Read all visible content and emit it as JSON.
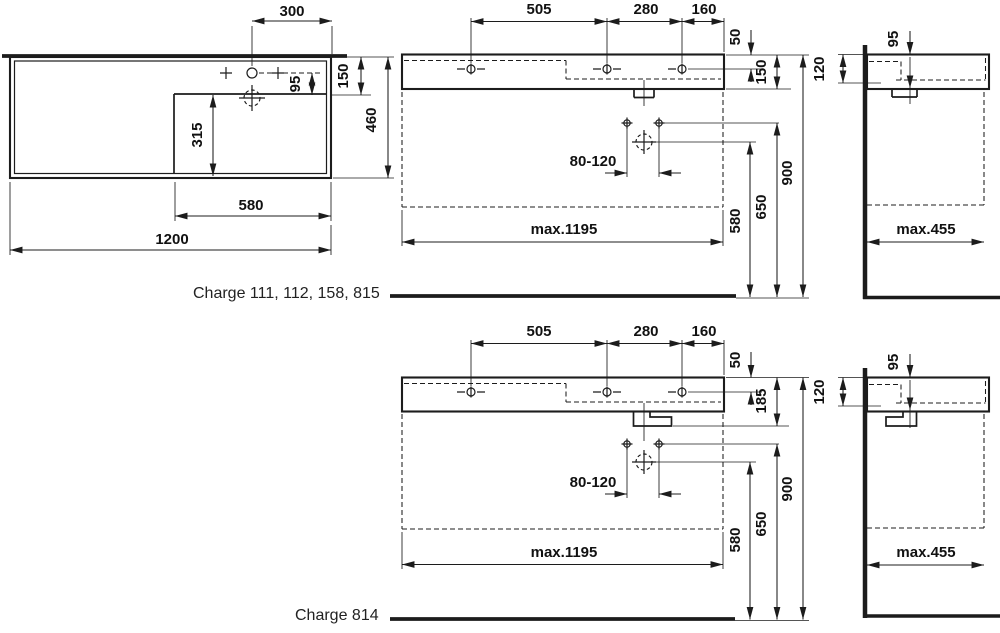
{
  "labels": {
    "variant_top": "Charge 111, 112, 158, 815",
    "variant_bottom": "Charge 814"
  },
  "colors": {
    "ink": "#1c1c1c",
    "background": "#ffffff"
  },
  "plan": {
    "d300": "300",
    "d150": "150",
    "d95": "95",
    "d315": "315",
    "d580": "580",
    "d1200": "1200",
    "d460": "460"
  },
  "front_top": {
    "d505": "505",
    "d280": "280",
    "d160": "160",
    "d50": "50",
    "d150": "150",
    "adjust": "80-120",
    "d580": "580",
    "d650": "650",
    "d900": "900",
    "max_width": "max.1195"
  },
  "side_top": {
    "d95": "95",
    "d120": "120",
    "max_depth": "max.455"
  },
  "front_bottom": {
    "d505": "505",
    "d280": "280",
    "d160": "160",
    "d50": "50",
    "d185": "185",
    "adjust": "80-120",
    "d580": "580",
    "d650": "650",
    "d900": "900",
    "max_width": "max.1195"
  },
  "side_bottom": {
    "d95": "95",
    "d120": "120",
    "max_depth": "max.455"
  }
}
